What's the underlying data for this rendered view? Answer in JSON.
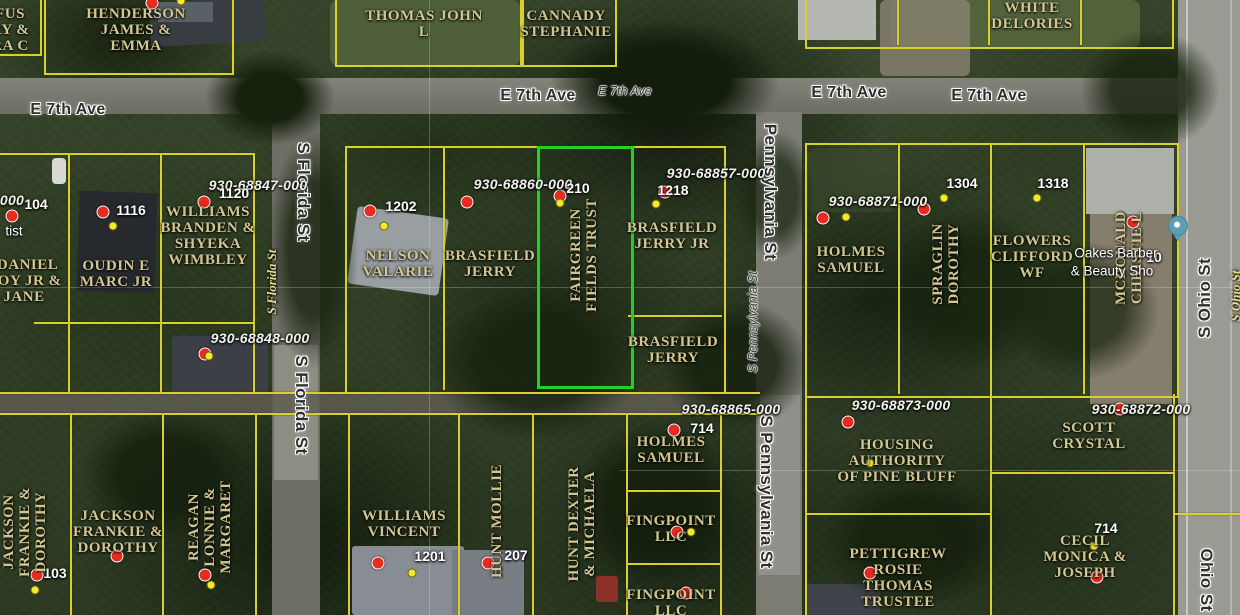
{
  "app": {
    "view": "county-gis-parcel-map-aerial"
  },
  "colors": {
    "parcel_line": "#d9d02e",
    "selected_parcel_line": "#23d123",
    "owner_text": "#d3c791",
    "parcel_id_text": "#f2f2ec",
    "house_number_text": "#ffffff",
    "red_marker": "#e82b1e",
    "yellow_marker": "#f4ea2a",
    "poi_pin": "#5e9db2"
  },
  "selected_parcel": {
    "owner": "FAIRGREEN FIELDS TRUST",
    "x": 537,
    "y": 146,
    "w": 91,
    "h": 237
  },
  "streets": {
    "labels": [
      {
        "text": "E 7th Ave",
        "x": 68,
        "y": 110,
        "rot": 0,
        "style": "street"
      },
      {
        "text": "E 7th Ave",
        "x": 538,
        "y": 96,
        "rot": 0,
        "style": "street"
      },
      {
        "text": "E 7th Ave",
        "x": 625,
        "y": 91,
        "rot": 0,
        "style": "maps-small"
      },
      {
        "text": "E 7th Ave",
        "x": 849,
        "y": 93,
        "rot": 0,
        "style": "street"
      },
      {
        "text": "E 7th Ave",
        "x": 989,
        "y": 96,
        "rot": 0,
        "style": "street"
      },
      {
        "text": "S Florida St",
        "x": 303,
        "y": 192,
        "rot": 90,
        "style": "street maps-vert"
      },
      {
        "text": "S Florida St",
        "x": 301,
        "y": 405,
        "rot": 90,
        "style": "street maps-vert"
      },
      {
        "text": "Pennsylvania St",
        "x": 770,
        "y": 192,
        "rot": 90,
        "style": "street maps-vert"
      },
      {
        "text": "S Pennsylvania St",
        "x": 766,
        "y": 492,
        "rot": 90,
        "style": "street maps-vert"
      },
      {
        "text": "S Pennsylvania St",
        "x": 753,
        "y": 322,
        "rot": -90,
        "style": "maps-small"
      },
      {
        "text": "S Ohio St",
        "x": 1205,
        "y": 298,
        "rot": -90,
        "style": "street maps-vert"
      },
      {
        "text": "Ohio St",
        "x": 1206,
        "y": 580,
        "rot": 90,
        "style": "street maps-vert"
      },
      {
        "text": "S Florida St",
        "x": 272,
        "y": 282,
        "rot": -90,
        "style": "gis"
      },
      {
        "text": "S Ohio St",
        "x": 1236,
        "y": 296,
        "rot": -90,
        "style": "gis"
      }
    ]
  },
  "parcels": {
    "ids": [
      {
        "text": "930-68847-000",
        "x": 258,
        "y": 185
      },
      {
        "text": "930-68848-000",
        "x": 260,
        "y": 338
      },
      {
        "text": "930-68860-000",
        "x": 523,
        "y": 184
      },
      {
        "text": "930-68857-000",
        "x": 716,
        "y": 173
      },
      {
        "text": "930-68871-000",
        "x": 878,
        "y": 201
      },
      {
        "text": "930-68865-000",
        "x": 731,
        "y": 409
      },
      {
        "text": "930-68873-000",
        "x": 901,
        "y": 405
      },
      {
        "text": "930-68872-000",
        "x": 1141,
        "y": 409
      },
      {
        "text": "000",
        "x": 12,
        "y": 200
      }
    ],
    "house_numbers": [
      {
        "text": "104",
        "x": 36,
        "y": 204
      },
      {
        "text": "1116",
        "x": 131,
        "y": 210
      },
      {
        "text": "1120",
        "x": 234,
        "y": 193
      },
      {
        "text": "1202",
        "x": 401,
        "y": 206
      },
      {
        "text": "210",
        "x": 578,
        "y": 188
      },
      {
        "text": "1218",
        "x": 673,
        "y": 190
      },
      {
        "text": "1304",
        "x": 962,
        "y": 183
      },
      {
        "text": "1318",
        "x": 1053,
        "y": 183
      },
      {
        "text": "714",
        "x": 702,
        "y": 428
      },
      {
        "text": "1201",
        "x": 430,
        "y": 556
      },
      {
        "text": "207",
        "x": 516,
        "y": 555
      },
      {
        "text": "714",
        "x": 1106,
        "y": 528
      },
      {
        "text": "103",
        "x": 55,
        "y": 573
      },
      {
        "text": "10",
        "x": 1154,
        "y": 257
      }
    ],
    "owners": [
      {
        "lines": [
          "FUS",
          "RY &",
          "RA C"
        ],
        "x": 10,
        "y": 30,
        "rot": 0
      },
      {
        "lines": [
          "HENDERSON",
          "JAMES &",
          "EMMA"
        ],
        "x": 136,
        "y": 30,
        "rot": 0
      },
      {
        "lines": [
          "THOMAS JOHN",
          "L"
        ],
        "x": 424,
        "y": 24,
        "rot": 0
      },
      {
        "lines": [
          "CANNADY",
          "STEPHANIE"
        ],
        "x": 566,
        "y": 24,
        "rot": 0
      },
      {
        "lines": [
          "WHITE",
          "DELORIES"
        ],
        "x": 1032,
        "y": 16,
        "rot": 0
      },
      {
        "lines": [
          "cDANIEL",
          "ROY JR &",
          "JANE"
        ],
        "x": 24,
        "y": 281,
        "rot": 0
      },
      {
        "lines": [
          "OUDIN E",
          "MARC JR"
        ],
        "x": 116,
        "y": 274,
        "rot": 0
      },
      {
        "lines": [
          "WILLIAMS",
          "BRANDEN &",
          "SHYEKA",
          "WIMBLEY"
        ],
        "x": 208,
        "y": 236,
        "rot": 0
      },
      {
        "lines": [
          "NELSON",
          "VALARIE"
        ],
        "x": 398,
        "y": 264,
        "rot": 0
      },
      {
        "lines": [
          "BRASFIELD",
          "JERRY"
        ],
        "x": 490,
        "y": 264,
        "rot": 0
      },
      {
        "lines": [
          "FAIRGREEN",
          "FIELDS TRUST"
        ],
        "x": 584,
        "y": 255,
        "rot": -90
      },
      {
        "lines": [
          "BRASFIELD",
          "JERRY JR"
        ],
        "x": 672,
        "y": 236,
        "rot": 0
      },
      {
        "lines": [
          "BRASFIELD",
          "JERRY"
        ],
        "x": 673,
        "y": 350,
        "rot": 0
      },
      {
        "lines": [
          "HOLMES",
          "SAMUEL"
        ],
        "x": 851,
        "y": 260,
        "rot": 0
      },
      {
        "lines": [
          "SPRAGLIN",
          "DOROTHY"
        ],
        "x": 946,
        "y": 264,
        "rot": -90
      },
      {
        "lines": [
          "FLOWERS",
          "CLIFFORD",
          "WF"
        ],
        "x": 1032,
        "y": 257,
        "rot": 0
      },
      {
        "lines": [
          "MCDONALD",
          "CHRISTIE L"
        ],
        "x": 1129,
        "y": 258,
        "rot": -90
      },
      {
        "lines": [
          "HOLMES",
          "SAMUEL"
        ],
        "x": 671,
        "y": 450,
        "rot": 0
      },
      {
        "lines": [
          "FINGPOINT",
          "LLC"
        ],
        "x": 671,
        "y": 529,
        "rot": 0
      },
      {
        "lines": [
          "FINGPOINT",
          "LLC"
        ],
        "x": 671,
        "y": 603,
        "rot": 0
      },
      {
        "lines": [
          "WILLIAMS",
          "VINCENT"
        ],
        "x": 404,
        "y": 524,
        "rot": 0
      },
      {
        "lines": [
          "HUNT MOLLIE"
        ],
        "x": 497,
        "y": 521,
        "rot": -90
      },
      {
        "lines": [
          "HUNT DEXTER",
          "& MICHAELA"
        ],
        "x": 582,
        "y": 524,
        "rot": -90
      },
      {
        "lines": [
          "HOUSING",
          "AUTHORITY",
          "OF PINE BLUFF"
        ],
        "x": 897,
        "y": 461,
        "rot": 0
      },
      {
        "lines": [
          "SCOTT",
          "CRYSTAL"
        ],
        "x": 1089,
        "y": 436,
        "rot": 0
      },
      {
        "lines": [
          "CECIL",
          "MONICA &",
          "JOSEPH"
        ],
        "x": 1085,
        "y": 557,
        "rot": 0
      },
      {
        "lines": [
          "PETTIGREW",
          "ROSIE",
          "THOMAS",
          "TRUSTEE"
        ],
        "x": 898,
        "y": 578,
        "rot": 0
      },
      {
        "lines": [
          "JACKSON",
          "FRANKIE &",
          "DOROTHY"
        ],
        "x": 25,
        "y": 532,
        "rot": -90
      },
      {
        "lines": [
          "JACKSON",
          "FRANKIE &",
          "DOROTHY"
        ],
        "x": 118,
        "y": 532,
        "rot": 0
      },
      {
        "lines": [
          "REAGAN",
          "LONNIE &",
          "MARGARET"
        ],
        "x": 210,
        "y": 527,
        "rot": -90
      }
    ]
  },
  "markers": {
    "red": [
      [
        152,
        3
      ],
      [
        12,
        216
      ],
      [
        103,
        212
      ],
      [
        204,
        202
      ],
      [
        205,
        354
      ],
      [
        370,
        211
      ],
      [
        467,
        202
      ],
      [
        560,
        196
      ],
      [
        665,
        192
      ],
      [
        823,
        218
      ],
      [
        924,
        209
      ],
      [
        1133,
        222
      ],
      [
        674,
        430
      ],
      [
        677,
        532
      ],
      [
        686,
        593
      ],
      [
        378,
        563
      ],
      [
        488,
        563
      ],
      [
        117,
        556
      ],
      [
        37,
        575
      ],
      [
        205,
        575
      ],
      [
        848,
        422
      ],
      [
        1120,
        409
      ],
      [
        1097,
        577
      ],
      [
        870,
        573
      ]
    ],
    "yellow": [
      [
        181,
        1
      ],
      [
        113,
        226
      ],
      [
        209,
        356
      ],
      [
        384,
        226
      ],
      [
        560,
        203
      ],
      [
        656,
        204
      ],
      [
        846,
        217
      ],
      [
        944,
        198
      ],
      [
        1037,
        198
      ],
      [
        691,
        532
      ],
      [
        412,
        573
      ],
      [
        35,
        590
      ],
      [
        211,
        585
      ],
      [
        870,
        463
      ],
      [
        1094,
        546
      ]
    ]
  },
  "poi": {
    "pin": {
      "x": 1178,
      "y": 238
    },
    "labels": [
      {
        "text": "tist",
        "x": 14,
        "y": 231
      },
      {
        "text": "Oakes Barber",
        "x": 1116,
        "y": 253
      },
      {
        "text": "& Beauty Sho",
        "x": 1112,
        "y": 271
      }
    ]
  }
}
